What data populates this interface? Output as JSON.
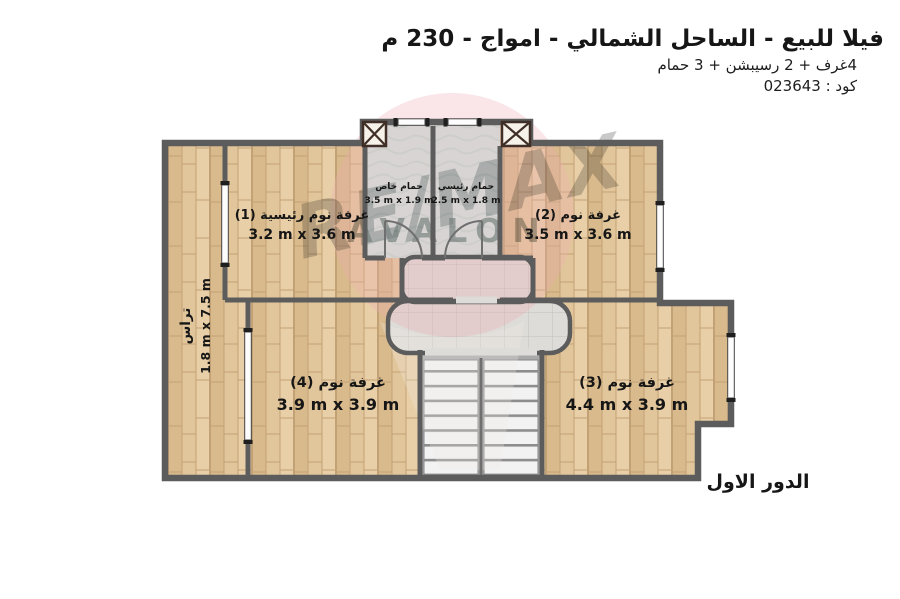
{
  "header": {
    "title": "فيلا للبيع - الساحل الشمالي - امواج - 230 م",
    "subtitle": "4غرف + 2 رسيبشن + 3 حمام",
    "code": "كود : 023643"
  },
  "floor_label": "الدور الاول",
  "watermark": {
    "brand": "RE/MAX",
    "name": "AVALON"
  },
  "plan": {
    "rooms": [
      {
        "key": "master-bedroom",
        "name": "غرفة نوم رئيسية (1)",
        "dims": "3.2 m x 3.6 m"
      },
      {
        "key": "bedroom-2",
        "name": "غرفة نوم (2)",
        "dims": "3.5 m x 3.6 m"
      },
      {
        "key": "bedroom-3",
        "name": "غرفة نوم (3)",
        "dims": "4.4 m x 3.9 m"
      },
      {
        "key": "bedroom-4",
        "name": "غرفة نوم (4)",
        "dims": "3.9 m x 3.9 m"
      },
      {
        "key": "private-bathroom",
        "name": "حمام خاص",
        "dims": "3.5 m x 1.9 m"
      },
      {
        "key": "main-bathroom",
        "name": "حمام رئيسي",
        "dims": "2.5 m x 1.8 m"
      },
      {
        "key": "terrace",
        "name": "تراس",
        "dims": "1.8 m x 7.5 m"
      }
    ]
  },
  "colors": {
    "wood_floor": "#e2c69b",
    "bathroom_floor": "#cfe6e2",
    "hall_tile": "#dedcd8",
    "wall": "#5c5c5c",
    "watermark_pink": "#eeacb2",
    "watermark_red": "#c9403c",
    "watermark_blue": "#7d95aa"
  }
}
